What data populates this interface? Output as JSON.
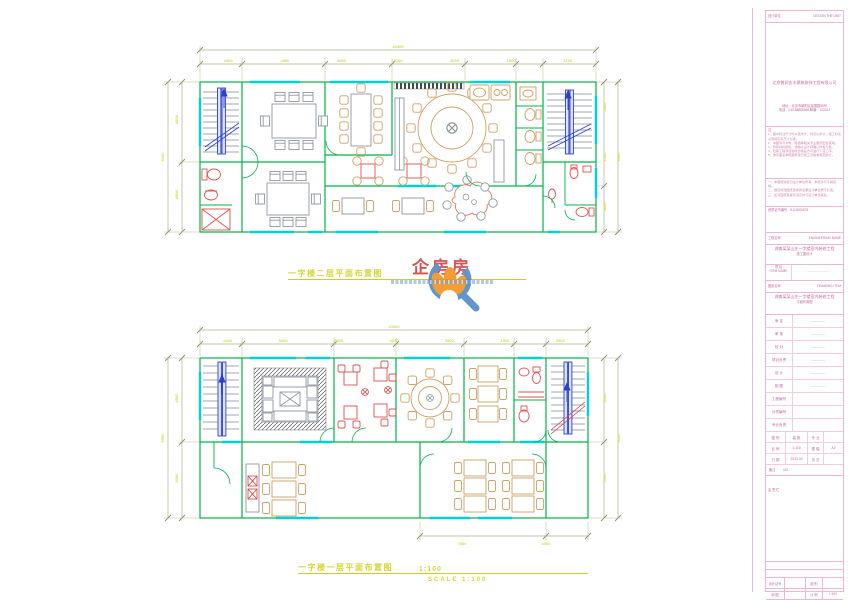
{
  "plan_titles": {
    "top": {
      "text": "一字楼二层平面布置图"
    },
    "bottom": {
      "text": "一字楼一层平面布置图",
      "scale": "1:100",
      "scale_note": "SCALE 1:100"
    }
  },
  "watermark": {
    "brand": "企房房"
  },
  "dimensions": {
    "top_plan": {
      "overall": "24400",
      "segments": [
        "2400",
        "4800",
        "3900",
        "4200",
        "3000",
        "1500",
        "3100"
      ],
      "left_overall": "9300",
      "left": [
        "4800",
        "4500"
      ],
      "right_overall": "9000",
      "right": [
        "4800",
        "1400",
        "2800"
      ]
    },
    "bottom_plan": {
      "overall": "23300",
      "segments": [
        "2400",
        "5300",
        "3600",
        "4000",
        "2900",
        "1900",
        "2500"
      ],
      "left_overall": "9500",
      "left": [
        "5000",
        "4500"
      ],
      "right_overall": "9500",
      "right": [
        "5000",
        "4500"
      ],
      "bottom": [
        "7500",
        "2500"
      ]
    }
  },
  "title_block": {
    "design_unit_label": "设计单位",
    "design_unit_en": "DESIGN THE UNIT",
    "company": "北京普润金丰建筑装饰工程有限公司",
    "address_line": "地址：北京市朝阳区建国路88号",
    "phone_line": "电话：010-88886666  邮编：100022",
    "notes_label": "注：",
    "notes": [
      "1、图中标注尺寸均以毫米计，标高以米计，施工时请以现场实际尺寸为准。",
      "2、本图须与水电、暖通等相关专业图纸配合使用。",
      "3、所有材料颜色、规格以设计师确认样板为准。",
      "4、隐蔽工程须经验收合格后方可进行下道工序。",
      "5、未尽事宜参照国家现行施工及验收规范执行。"
    ],
    "statements": [
      "一、本图纸版权归设计单位所有，未经许可不得复制。",
      "二、擅自修改图纸造成的后果设计单位概不负责。",
      "三、如对图纸有疑问请及时与设计单位联系。"
    ],
    "cert_line": "资质证书编号：B113005678",
    "eng_header": "工程名称",
    "eng_header_en": "ENGINEERING NAME",
    "eng_line1": "湖南某某山庄一字楼室内装修工程",
    "eng_line2": "施工图设计",
    "item_label": "项 目",
    "item_en": "ITEM NAME",
    "item_value": "－－－－－－－",
    "draw_header": "图纸名称",
    "draw_header_en": "DRAWING ITEM",
    "draw_line1": "湖南某某山庄一字楼室内装修工程",
    "draw_line2": "平面布置图",
    "sign_rows": [
      {
        "label": "审 定",
        "value": "————"
      },
      {
        "label": "审 核",
        "value": "————"
      },
      {
        "label": "校 对",
        "value": "————"
      },
      {
        "label": "项目负责",
        "value": "————"
      },
      {
        "label": "设 计",
        "value": "————"
      },
      {
        "label": "制 图",
        "value": "————"
      }
    ],
    "meta_rows": [
      {
        "label": "工程编号",
        "value": ""
      },
      {
        "label": "分项编号",
        "value": ""
      },
      {
        "label": "专业负责",
        "value": ""
      }
    ],
    "pair_rows": [
      {
        "l1": "图 别",
        "v1": "装 施",
        "l2": "专 业",
        "v2": ""
      },
      {
        "l1": "比 例",
        "v1": "1:100",
        "l2": "图 幅",
        "v2": "A2"
      },
      {
        "l1": "日 期",
        "v1": "2013.04",
        "l2": "页 次",
        "v2": ""
      }
    ],
    "remark_label": "备注",
    "remark_no": "NO.",
    "signoff_label": "会 签 栏",
    "bottom_grid": [
      {
        "c1": "设计证号",
        "v1": "",
        "c2": "图 别",
        "v2": ""
      },
      {
        "c1": "制 图",
        "v1": "",
        "c2": "比 例",
        "v2": "1:100"
      },
      {
        "c1": "审 核",
        "v1": "",
        "c2": "日 期",
        "v2": "2013.04"
      }
    ]
  },
  "colors": {
    "wall": "#00b44a",
    "window": "#00d2d2",
    "stair": "#2a3fd0",
    "furniture_gray": "#9098a2",
    "furniture_tan": "#cfa066",
    "fixture_red": "#e05252",
    "dimension_line": "#b3b38c",
    "dimension_text": "#d9d94a",
    "plan_title": "#d6d636",
    "title_block": "#eeb6d5"
  }
}
